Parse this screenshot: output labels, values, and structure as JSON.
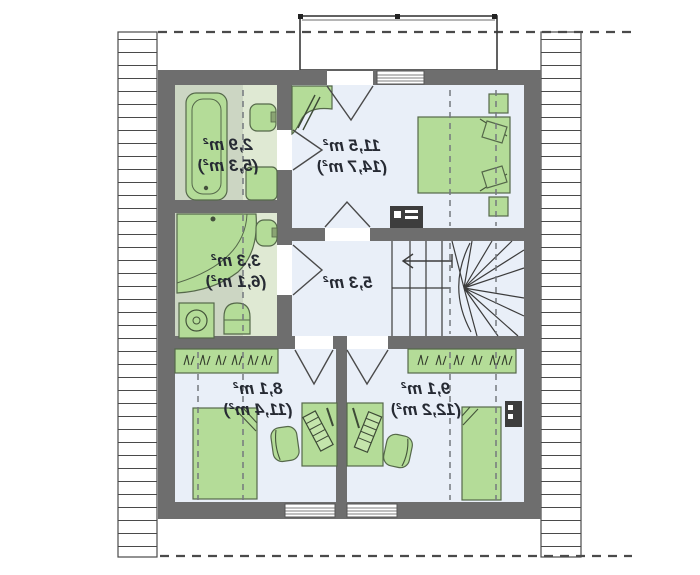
{
  "plan": {
    "type": "attic-floor-plan",
    "mirrored_labels": true,
    "rooms": [
      {
        "id": "bathroom-top",
        "area": "2,9 m²",
        "floor_area": "(5,3 m²)"
      },
      {
        "id": "bathroom-middle",
        "area": "3,3 m²",
        "floor_area": "(6,1 m²)"
      },
      {
        "id": "bedroom-top",
        "area": "11,5 m²",
        "floor_area": "(14,7 m²)"
      },
      {
        "id": "hall",
        "area": "5,3 m²",
        "floor_area": ""
      },
      {
        "id": "room-bottom-left",
        "area": "8,1 m²",
        "floor_area": "(11,4 m²)"
      },
      {
        "id": "room-bottom-right",
        "area": "9,1 m²",
        "floor_area": "(12,2 m²)"
      }
    ],
    "colors": {
      "wall": "#6e6e6e",
      "room_floor": "#e9eff8",
      "bathroom_floor": "#dfe9d3",
      "bathroom_floor_dark": "#ccd6c3",
      "furniture": "#b4dc98",
      "furniture_outline": "#55684a",
      "label_text": "#262a33",
      "hatch_line": "#4a4a4a"
    },
    "furniture_items": [
      "bathtub",
      "sink",
      "toilet",
      "corner-bathtub",
      "washing-machine",
      "double-bed",
      "single-bed",
      "nightstand",
      "wardrobe",
      "desk",
      "office-chair",
      "winder-staircase",
      "radiator",
      "tv-unit",
      "balcony-dormer"
    ]
  }
}
